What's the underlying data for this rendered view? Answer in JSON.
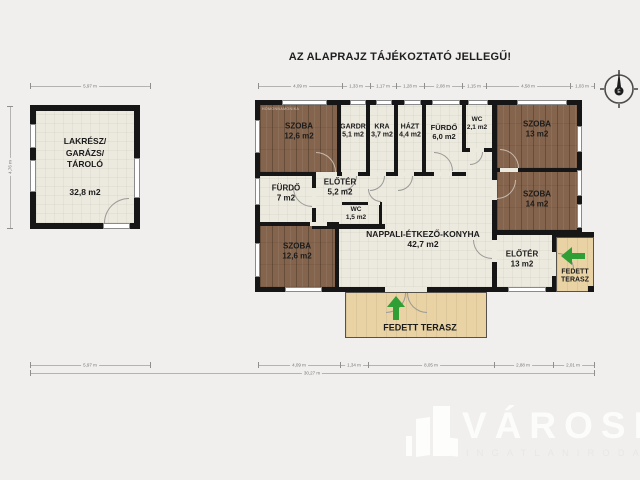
{
  "title": "AZ ALAPRAJZ TÁJÉKOZTATÓ JELLEGŰ!",
  "watermark": "HOMONNAMONIKA",
  "compass": {
    "north": "É"
  },
  "outbuilding": {
    "line1": "LAKRÉSZ/",
    "line2": "GARÁZS/",
    "line3": "TÁROLÓ",
    "area": "32,8 m2"
  },
  "rooms": {
    "szoba1": {
      "name": "SZOBA",
      "area": "12,6 m2"
    },
    "gardrob": {
      "name": "GARDR",
      "area": "5,1 m2"
    },
    "kra": {
      "name": "KRA",
      "area": "3,7 m2"
    },
    "hazt": {
      "name": "HÁZT",
      "area": "4,4 m2"
    },
    "furdo6": {
      "name": "FÜRDŐ",
      "area": "6,0 m2"
    },
    "wc1": {
      "name": "WC",
      "area": "2,1 m2"
    },
    "szoba13": {
      "name": "SZOBA",
      "area": "13 m2"
    },
    "szoba14": {
      "name": "SZOBA",
      "area": "14 m2"
    },
    "furdo7": {
      "name": "FÜRDŐ",
      "area": "7 m2"
    },
    "eloter1": {
      "name": "ELŐTÉR",
      "area": "5,2 m2"
    },
    "wc2": {
      "name": "WC",
      "area": "1,5 m2"
    },
    "szoba4": {
      "name": "SZOBA",
      "area": "12,6 m2"
    },
    "nappali": {
      "name": "NAPPALI-ÉTKEZŐ-KONYHA",
      "area": "42,7 m2"
    },
    "eloter13": {
      "name": "ELŐTÉR",
      "area": "13 m2"
    },
    "terasz_right": {
      "name": "FEDETT TERASZ"
    },
    "terasz_bottom": {
      "name": "FEDETT TERASZ"
    }
  },
  "dimensions": {
    "garage_top": "5,97 m",
    "garage_left": "4,76 m",
    "garage_bottom": "5,97 m",
    "main_top": [
      "4,09 m",
      "1,33 m",
      "1,17 m",
      "1,28 m",
      "2,08 m",
      "1,15 m",
      "4,58 m",
      "1,03 m"
    ],
    "bottom": [
      "4,09 m",
      "1,34 m",
      "8,05 m",
      "2,88 m",
      "2,01 m"
    ],
    "total": "30,27 m"
  },
  "logo": {
    "brand": "VÁROSI",
    "subtitle": "INGATLANIRODA"
  },
  "colors": {
    "wall": "#161616",
    "floor": "#ece9df",
    "wood": "#84644c",
    "terrace": "#e9d3a4",
    "arrow": "#2f9e35"
  }
}
